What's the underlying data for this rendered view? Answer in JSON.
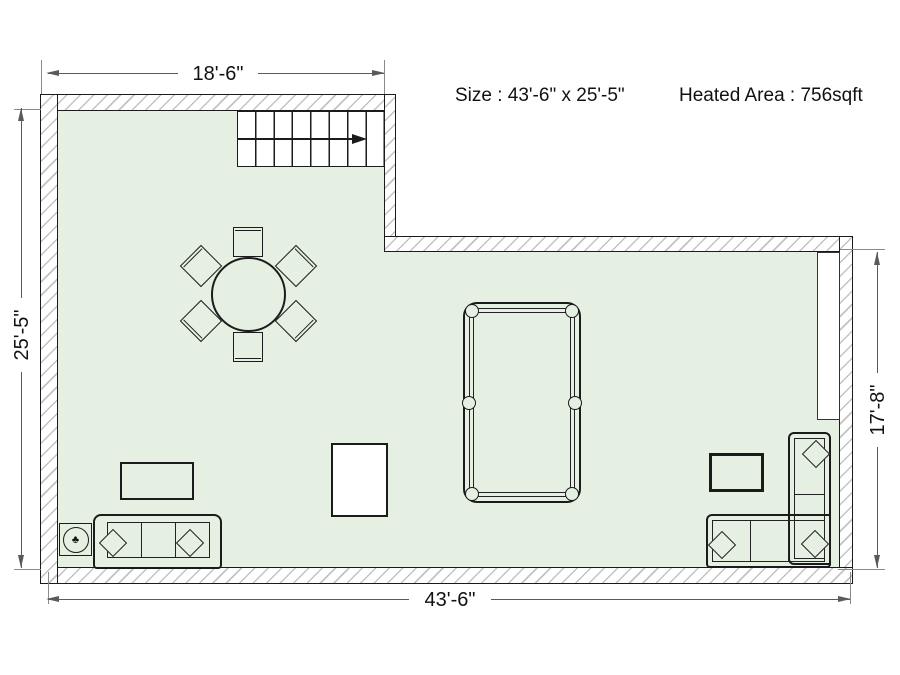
{
  "header": {
    "size_text": "Size : 43'-6\" x 25'-5\"",
    "heated_area_text": "Heated Area : 756sqft"
  },
  "dimensions": {
    "top": "18'-6\"",
    "left": "25'-5\"",
    "bottom": "43'-6\"",
    "right": "17'-8\""
  },
  "icons": {
    "plant": "♣"
  },
  "colors": {
    "floor_fill": "#e5f0e3",
    "wall_hatch": "#c3c3c3",
    "outline": "#1b1b1b",
    "dimension_line": "#5a5a5a",
    "background": "#ffffff"
  },
  "furniture_labels": {
    "stairs": "stairs",
    "dining_table": "round dining table with 6 chairs",
    "pool_table": "pool table",
    "sofa_left": "three-seat sofa",
    "sofa_right": "l-shaped sectional sofa",
    "coffee_table": "coffee table",
    "side_table": "side table with plant",
    "tv_cabinet": "tv cabinet",
    "white_box": "storage box",
    "closet": "closet / door recess"
  }
}
